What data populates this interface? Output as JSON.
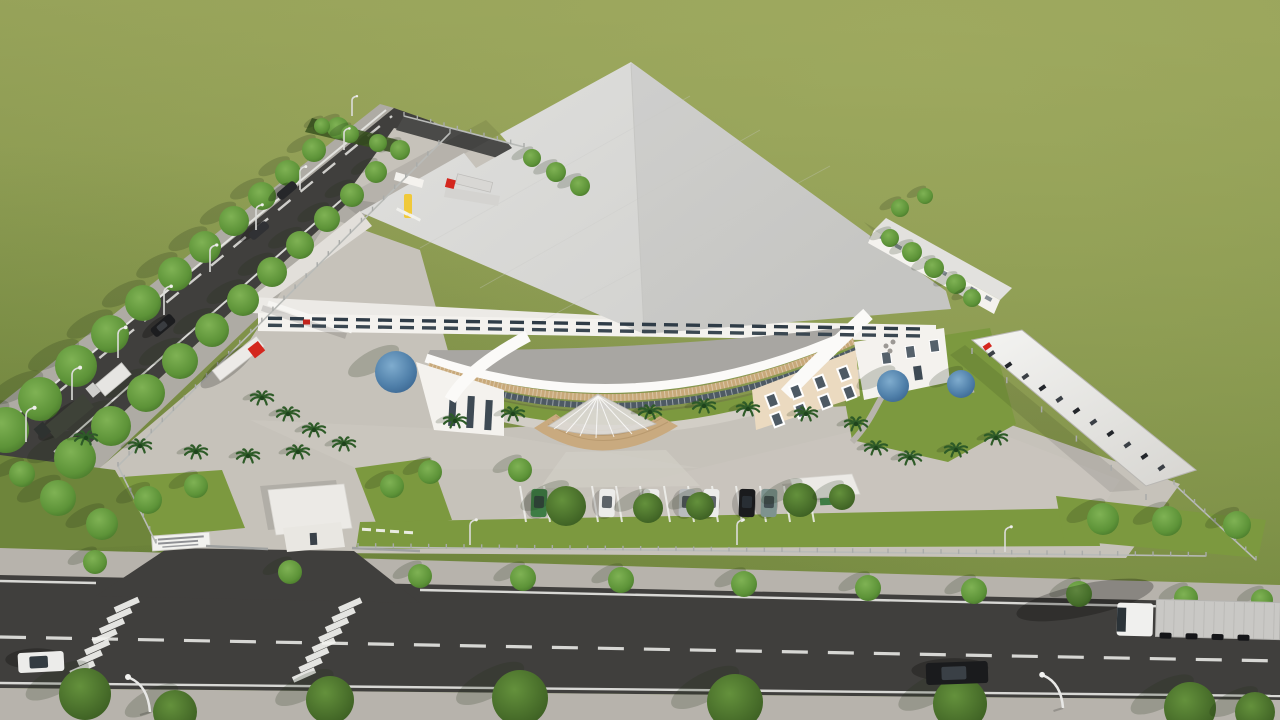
{
  "meta": {
    "type": "3d-architectural-aerial-rendering",
    "subject": "industrial factory campus with curved office building, landscaped yard and boulevard"
  },
  "labels": {
    "field": "grass-field",
    "factory": "main-production-hall",
    "office": "curved-office-building",
    "annex": "utility-annex",
    "carport": "bike-carport-canopy",
    "gatehouse": "gate-guardhouse",
    "sign": "entrance-signboard",
    "pavilion": "rest-pavilion",
    "front_road": "boulevard",
    "west_road": "access-road",
    "entrance_canopy": "fan-shaped-entrance-canopy",
    "loading_dock": "truck-loading-dock"
  },
  "palette": {
    "field_light": "#95A158",
    "field_mid": "#81934A",
    "field_dark": "#6E853B",
    "lawn": "#7C993F",
    "roof_light": "#E0E0DE",
    "roof_shade": "#D0D0CD",
    "roof_white": "#ECEAE6",
    "wall_white": "#F4F2EE",
    "wall_shadow": "#E2DFDA",
    "office_gray": "#A8A6A2",
    "fascia_white": "#FBFAF8",
    "louver_tan": "#C8A97A",
    "glass_dark": "#4E5A64",
    "beige_wall": "#EBDAC0",
    "steps_tan": "#C9AA7F",
    "asphalt": "#403F3D",
    "asphalt_light": "#4A4947",
    "concrete": "#C6C2BA",
    "concrete_light": "#D2CEC6",
    "sidewalk": "#B7B3AC",
    "marking_white": "#F2F2EF",
    "tree_green": "#5E9A3C",
    "tree_blue": "#5B8FB9",
    "palm_green": "#2E5B28",
    "truck_red": "#D4271E",
    "container_gray": "#C9C8C5",
    "car_black": "#1A1B1D",
    "car_white": "#ECECEA",
    "car_green": "#3E7D45",
    "car_silver": "#B9BCBE",
    "car_teal": "#7E938F",
    "accent_yellow": "#F0C93A",
    "logo_red": "#C3241C",
    "fence_gray": "#A9ABA9"
  },
  "sign": {
    "text_lines": 3
  },
  "vegetation": {
    "street_trees": 48,
    "hedge_trees": 5,
    "sidewalk_trees": 11,
    "boulevard_trees": 8,
    "blue_ornamental_trees": 3,
    "palm_trees": 20
  },
  "vehicles": {
    "trucks": 5,
    "cars": 6,
    "parked_cars": 7,
    "motorbikes_under_carport": 12
  },
  "site_features": {
    "crosswalks": 2,
    "street_lamps": 14,
    "fence_posts": 101,
    "parking_stalls": 12,
    "factory_window_rows": 2
  }
}
